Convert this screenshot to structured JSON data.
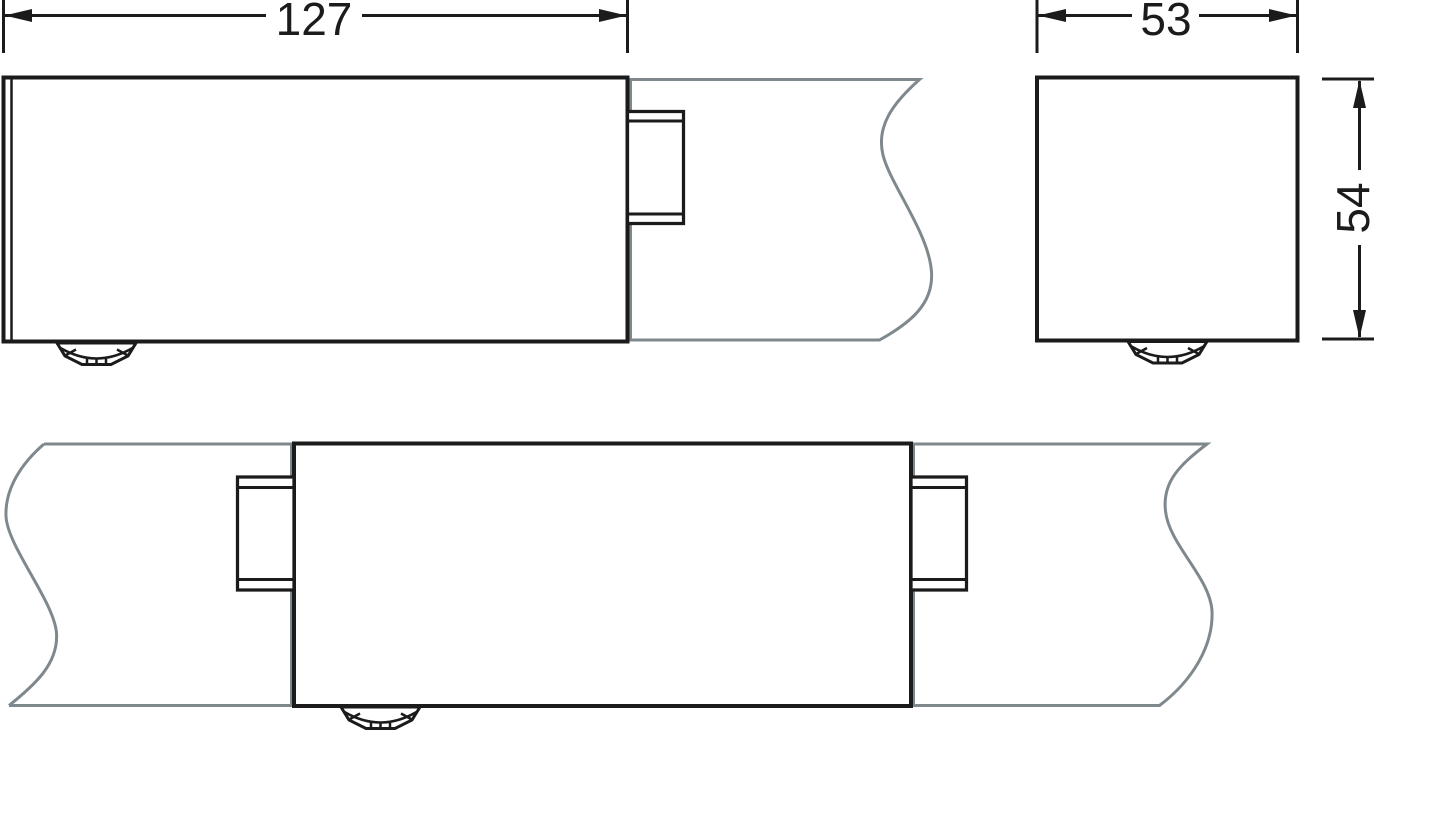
{
  "drawing": {
    "kind": "technical-dimension-drawing",
    "dimensions": {
      "front_width": "127",
      "end_width": "53",
      "end_height": "54"
    },
    "colors": {
      "ink": "#1b1b1b",
      "rail": "#7e888d",
      "background": "#ffffff"
    }
  }
}
